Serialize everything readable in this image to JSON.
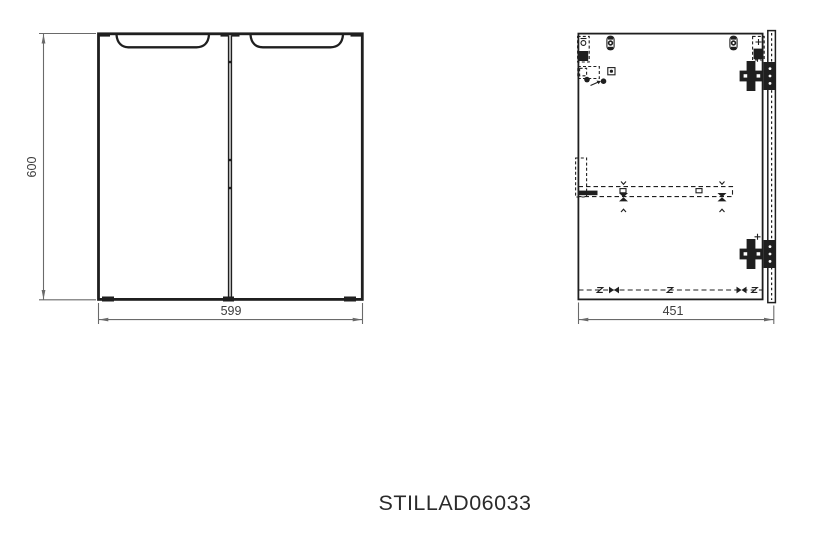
{
  "product": {
    "code": "STILLAD06033"
  },
  "front_view": {
    "height_dimension": "600",
    "width_dimension": "599"
  },
  "side_view": {
    "depth_dimension": "451"
  },
  "colors": {
    "background": "#ffffff",
    "line": "#1f1f1f",
    "dimension": "#6a6a6a",
    "dim-text": "#3d3d3d",
    "caption-text": "#2b2b2b"
  }
}
